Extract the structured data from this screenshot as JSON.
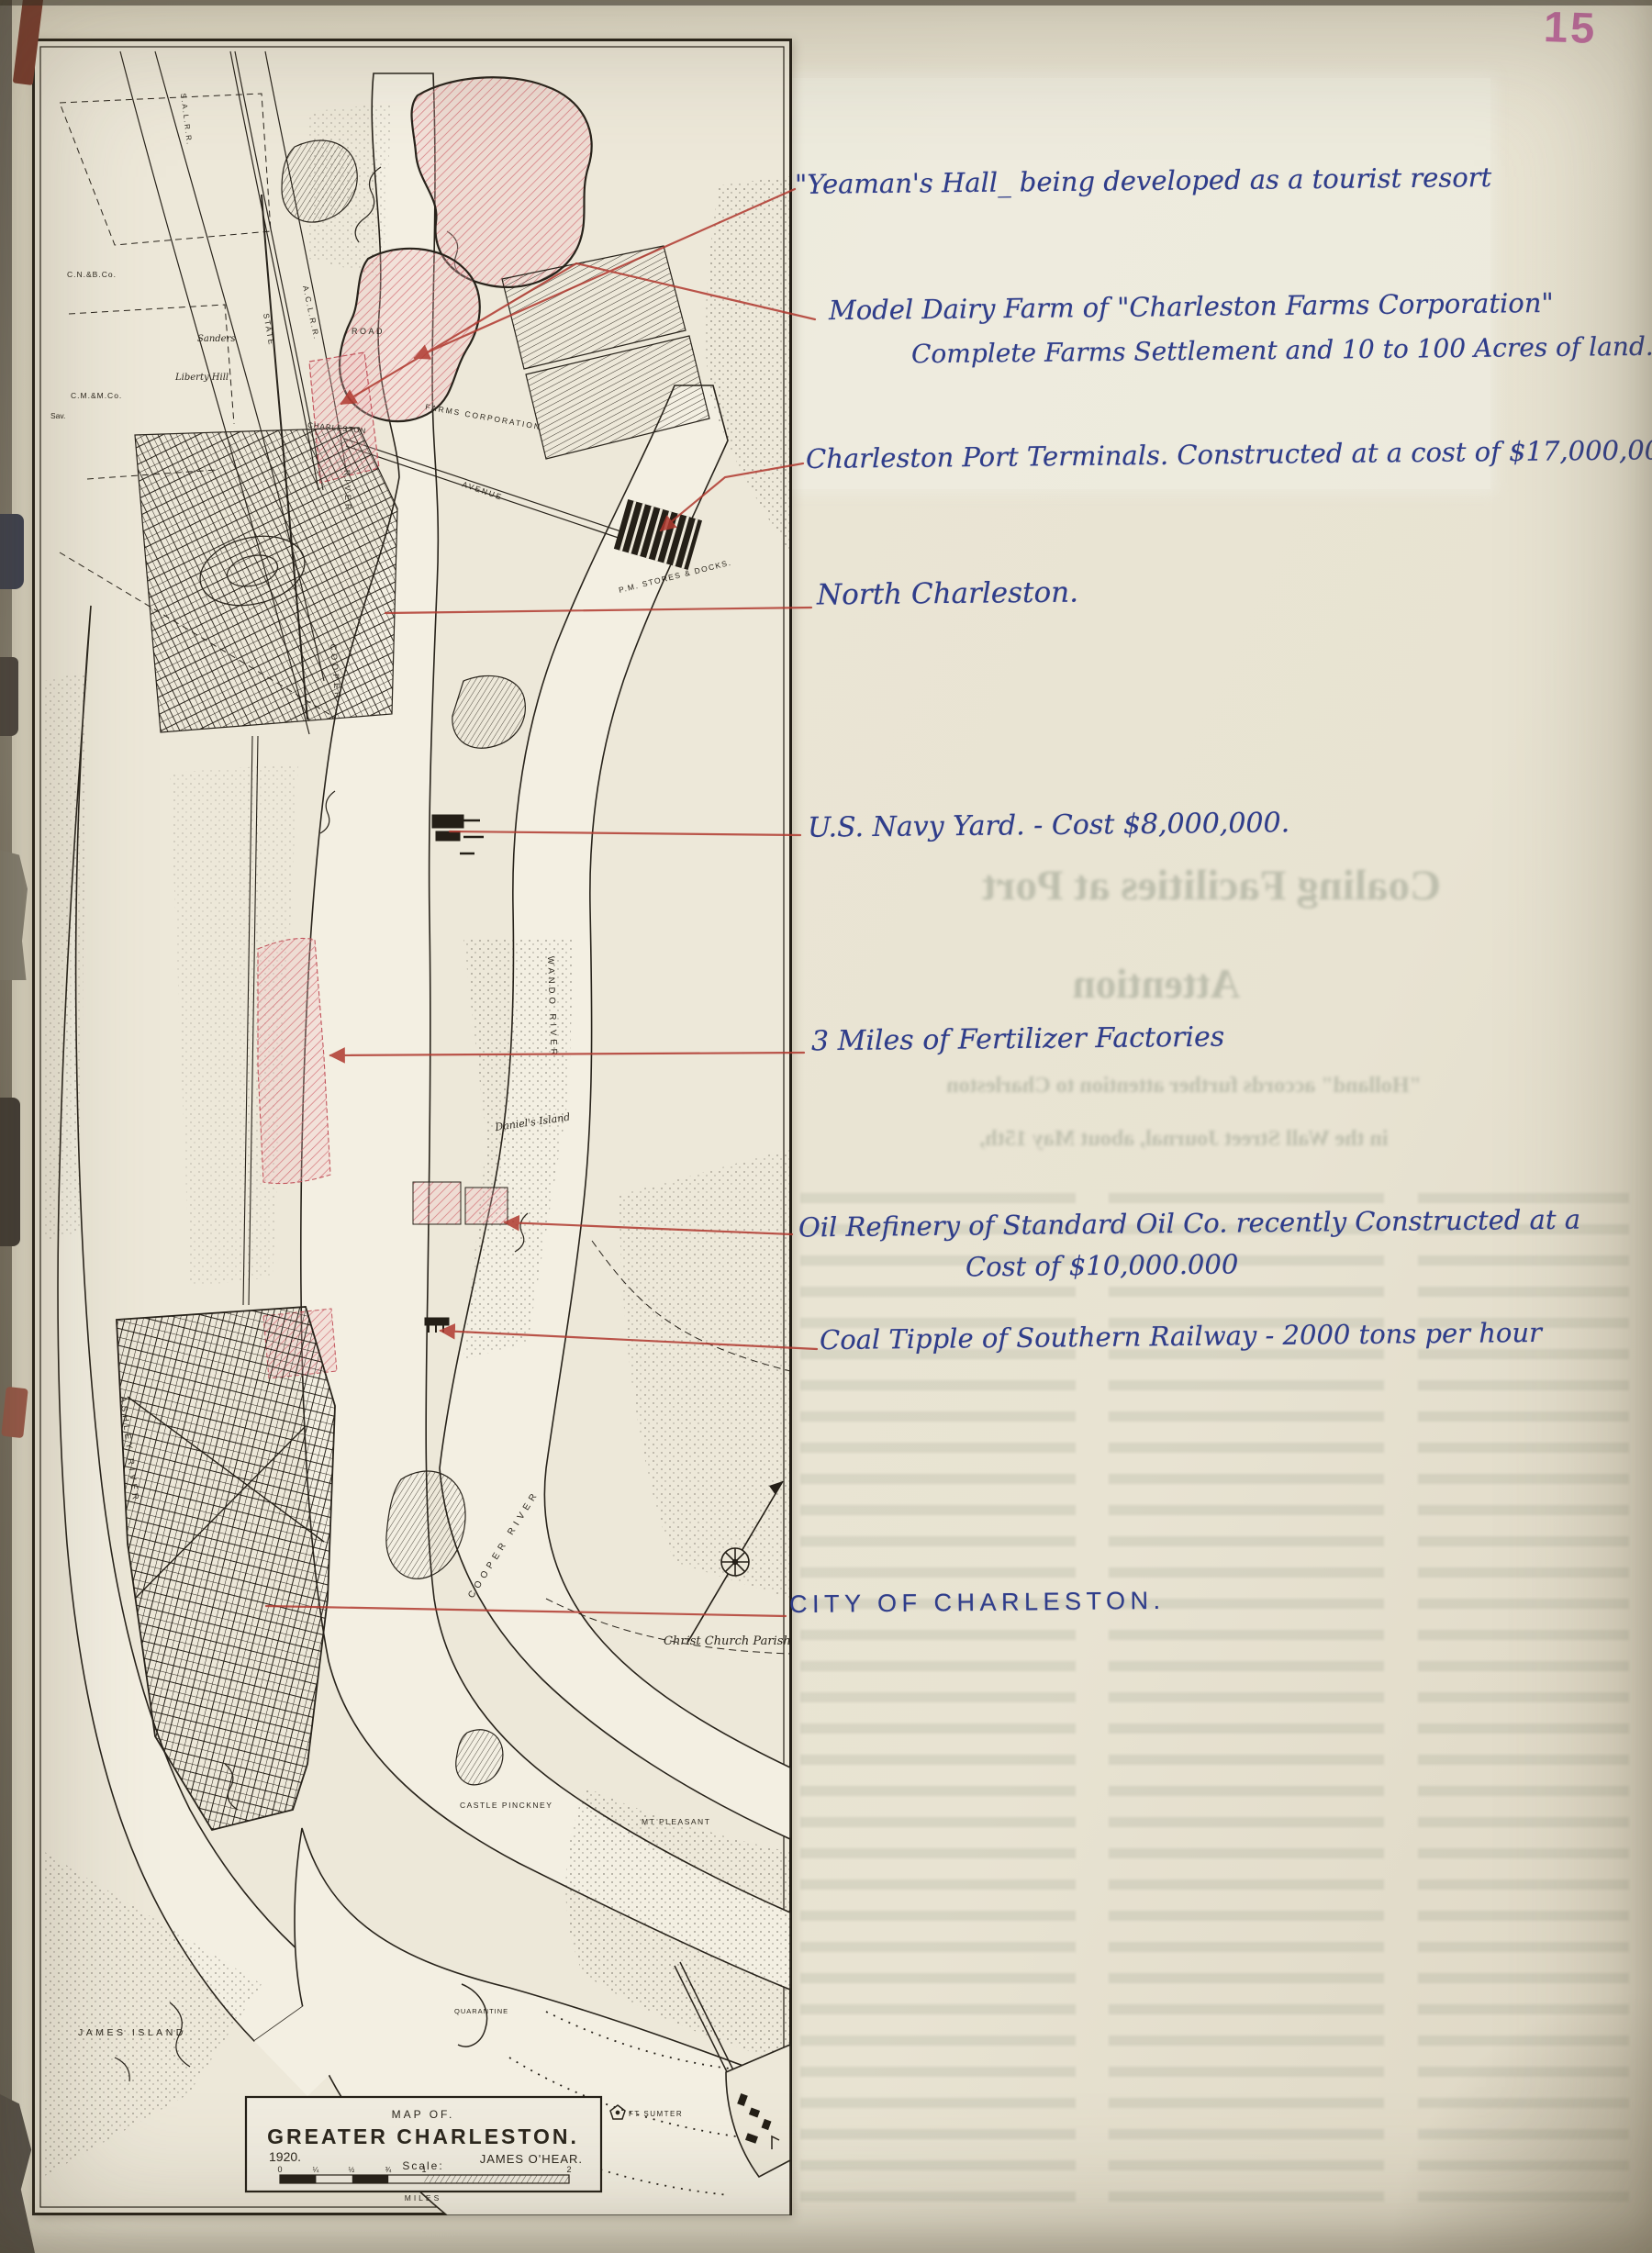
{
  "page": {
    "number": "15"
  },
  "annotations": {
    "yeamans_hall": "\"Yeaman's Hall_ being developed as a tourist resort",
    "model_dairy_1": "Model Dairy Farm of \"Charleston Farms Corporation\"",
    "model_dairy_2": "Complete Farms Settlement and 10 to 100 Acres of land.",
    "port_terminals": "Charleston Port Terminals. Constructed at a cost of $17,000,000.",
    "north_charleston": "North Charleston.",
    "navy_yard": "U.S. Navy Yard. - Cost $8,000,000.",
    "fertilizer": "3 Miles of Fertilizer Factories",
    "oil_refinery_1": "Oil Refinery of Standard Oil Co. recently Constructed at a",
    "oil_refinery_2": "Cost of $10,000.000",
    "coal_tipple": "Coal Tipple of Southern Railway - 2000 tons per hour",
    "city": "CITY OF CHARLESTON."
  },
  "map": {
    "title_box": {
      "map_of": "MAP OF.",
      "title": "GREATER CHARLESTON.",
      "year": "1920.",
      "author": "JAMES O'HEAR.",
      "scale_label": "Scale:",
      "miles": "MILES",
      "ticks": [
        "0",
        "¼",
        "½",
        "¾",
        "1",
        "2"
      ]
    },
    "labels": {
      "sal_rr": "S.A.L.R.R.",
      "acl_rr": "A.C.L.R.R.",
      "state": "STATE",
      "road": "ROAD",
      "cnb": "C.N.&B.Co.",
      "cmm": "C.M.&M.Co.",
      "sav": "Sav.",
      "charleston_plot": "CHARLESTON",
      "farms_corp": "FARMS CORPORATION",
      "avenue": "AVENUE",
      "sanders": "Sanders",
      "liberty_hill": "Liberty Hill",
      "pm_stores": "P.M. STORES & DOCKS.",
      "river_upper": "RIVER",
      "cooper_upper": "COOPER",
      "cooper_river": "COOPER RIVER",
      "wando_river": "WANDO RIVER",
      "ashley_river": "ASHLEY RIVER",
      "daniels_island": "Daniel's Island",
      "christ_church": "Christ Church Parish",
      "castle_pinckney": "CASTLE PINCKNEY",
      "mt_pleasant": "MT PLEASANT",
      "james_island": "JAMES ISLAND",
      "quarantine": "QUARANTINE",
      "ft_sumter": "FT SUMTER"
    }
  },
  "bleed_through": {
    "headline_1": "Coaling Facilities at Port",
    "headline_2": "Attention",
    "subhead_1": "\"Holland\" accords further attention to Charleston",
    "subhead_2": "in the Wall Street Journal, about May 15th,"
  },
  "colors": {
    "ink_blue": "#2f3d8a",
    "leader_red": "#b0392f",
    "hatch_pink": "#d4737a",
    "page_number_pink": "#c05f9f"
  }
}
